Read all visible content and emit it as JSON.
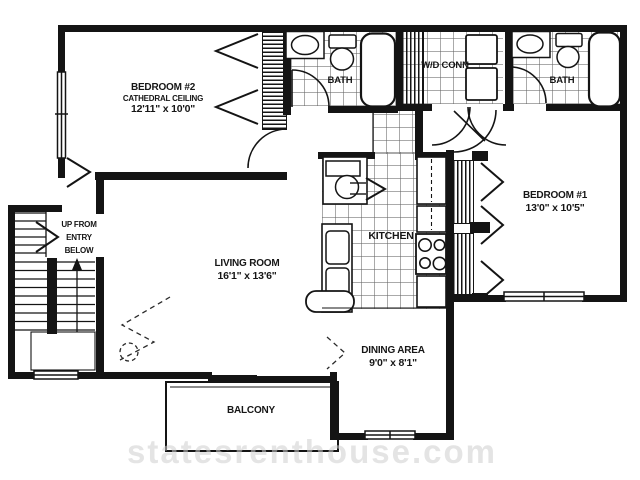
{
  "rooms": {
    "bedroom2": {
      "name": "BEDROOM #2",
      "note": "CATHEDRAL CEILING",
      "dims": "12'11\" x 10'0\""
    },
    "bath1": {
      "name": "BATH"
    },
    "wd_conn": {
      "name": "W/D CONN"
    },
    "bath2": {
      "name": "BATH"
    },
    "bedroom1": {
      "name": "BEDROOM #1",
      "dims": "13'0\" x 10'5\""
    },
    "living_room": {
      "name": "LIVING ROOM",
      "dims": "16'1\" x 13'6\""
    },
    "kitchen": {
      "name": "KITCHEN"
    },
    "dining_area": {
      "name": "DINING AREA",
      "dims": "9'0\" x 8'1\""
    },
    "balcony": {
      "name": "BALCONY"
    },
    "stairs": {
      "line1": "UP FROM",
      "line2": "ENTRY",
      "line3": "BELOW"
    }
  },
  "watermark": "statesrenthouse.com",
  "colors": {
    "wall": "#141414",
    "tile_line": "#646464",
    "watermark": "#cdcdcd",
    "background": "#ffffff"
  }
}
